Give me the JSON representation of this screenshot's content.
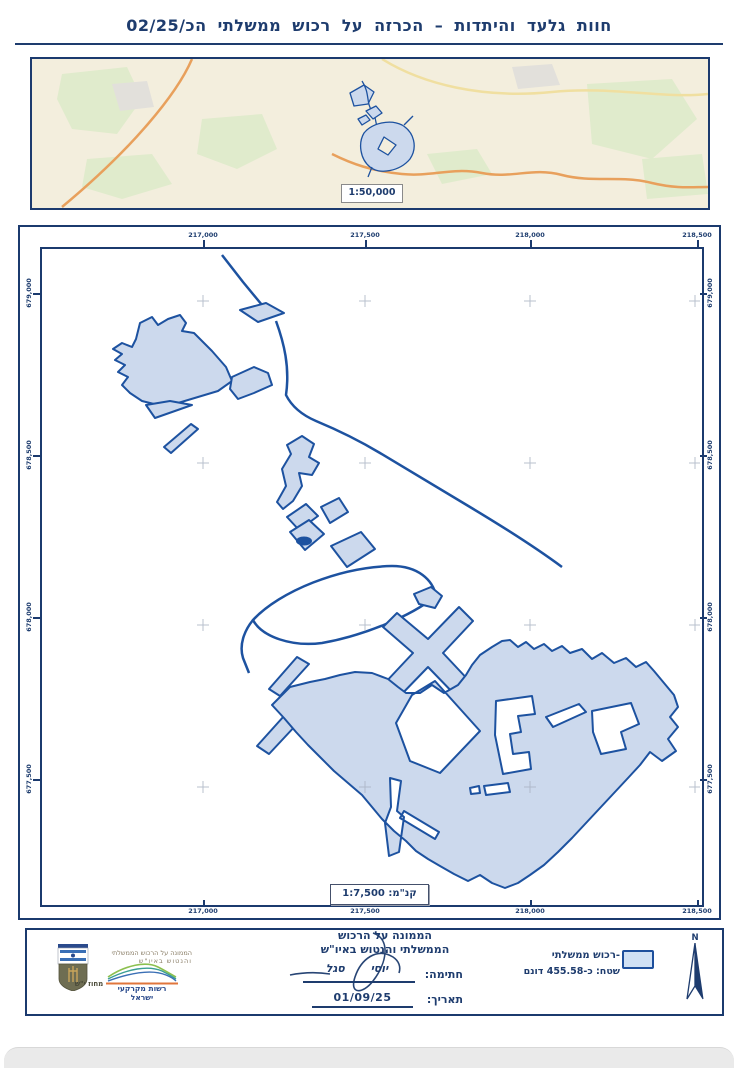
{
  "title": "חוות גלעד והיתדות – הכרזה על רכוש ממשלתי הכ/02/25",
  "overview_map": {
    "scale_label": "1:50,000"
  },
  "main_map": {
    "scale_prefix": "קנ\"מ:",
    "scale_value": "1:7,500",
    "x_ticks": [
      "217,000",
      "217,500",
      "218,000",
      "218,500"
    ],
    "y_ticks": [
      "679,000",
      "678,500",
      "678,000",
      "677,500"
    ]
  },
  "footer": {
    "authority_line1": "הממונה על הרכוש",
    "authority_line2": "הממשלתי והנטוש באיו\"ש",
    "signature_label": "חתימה:",
    "signature_name": "יוסי סגל",
    "date_label": "תאריך:",
    "date_value": "01/09/25",
    "legend_item_label": "-רכוש ממשלתי",
    "legend_area_label": "שטח: כ-455.58 דונם",
    "north_label": "N",
    "org_small_line1": "הממונה על הרכוש הממשלתי",
    "org_small_line2": "והנטוש באיו\"ש",
    "ila_name": "רשות מקרקעי ישראל",
    "district": "מחוז י\"ש"
  },
  "colors": {
    "navy": "#1e3c6e",
    "parcel_outline": "#1d52a0",
    "parcel_fill": "#ccd9ed",
    "road_orange": "#e8a05c",
    "overview_bg": "#f3eedd"
  }
}
